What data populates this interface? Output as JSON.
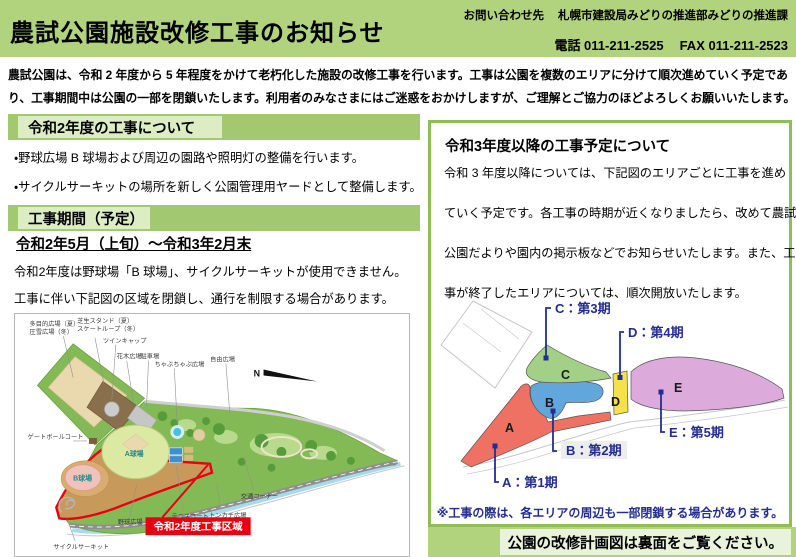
{
  "colors": {
    "banner_green": "#b2d37e",
    "bar_green": "#a2c96f",
    "bar_inner": "#dcecc3",
    "box_border": "#8dbf57",
    "pale_box": "#e9f2da",
    "navy": "#232d91",
    "red": "#e60012",
    "area_a": "#ef7163",
    "area_b": "#61a7dc",
    "area_c": "#a3d086",
    "area_d": "#f6e04b",
    "area_e": "#dcabdc"
  },
  "header": {
    "title": "農試公園施設改修工事のお知らせ",
    "contact_label": "お問い合わせ先",
    "contact_org": "札幌市建設局みどりの推進部みどりの推進課",
    "phone": "電話 011-211-2525",
    "fax": "FAX 011-211-2523"
  },
  "intro_lines": [
    "農試公園は、令和 2 年度から 5 年程度をかけて老朽化した施設の改修工事を行います。工事は公園を複数のエリアに分けて順次進めていく予定であ",
    "り、工事期間中は公園の一部を閉鎖いたします。利用者のみなさまにはご迷惑をおかけしますが、ご理解とご協力のほどよろしくお願いいたします。"
  ],
  "left": {
    "section1_title": "令和2年度の工事について",
    "bullet1": "・野球広場 B 球場および周辺の園路や照明灯の整備を行います。",
    "bullet2": "・サイクルサーキットの場所を新しく公園管理用ヤードとして整備します。",
    "section2_title": "工事期間（予定）",
    "period": "令和2年5月（上旬）～令和3年2月末",
    "line1": "令和2年度は野球場「B 球場」、サイクルサーキットが使用できません。",
    "line2": "工事に伴い下記図の区域を閉鎖し、通行を制限する場合があります。"
  },
  "park_map": {
    "labels": {
      "multipurpose1": "多目的広場（夏）",
      "multipurpose2": "圧雪広場（冬）",
      "lawn1": "芝生スタンド（夏）",
      "lawn2": "スケートループ（冬）",
      "twincap": "ツインキャップ",
      "kaboku": "花木広場",
      "parking": "駐車場",
      "chapu": "ちゃぷちゃぷ広場",
      "jiyu": "自由広場",
      "gateball": "ゲートボールコート",
      "field_a": "A球場",
      "field_b": "B球場",
      "baseball": "野球広場",
      "tennis": "テニスコート",
      "tonkachi": "トンカチ広場",
      "traffic": "交通コーナー",
      "cycle": "サイクルサーキット",
      "compass": "N"
    },
    "zone_label": "令和2年度工事区域"
  },
  "right": {
    "title": "令和3年度以降の工事予定について",
    "body_lines": [
      "令和 3 年度以降については、下記図のエリアごとに工事を進め",
      "ていく予定です。各工事の時期が近くなりましたら、改めて農試",
      "公園だよりや園内の掲示板などでお知らせいたします。また、工",
      "事が終了したエリアについては、順次開放いたします。"
    ],
    "diagram": {
      "areas": [
        {
          "id": "A",
          "label": "A：第1期",
          "color": "#ef7163"
        },
        {
          "id": "B",
          "label": "B：第2期",
          "color": "#61a7dc"
        },
        {
          "id": "C",
          "label": "C：第3期",
          "color": "#a3d086"
        },
        {
          "id": "D",
          "label": "D：第4期",
          "color": "#f6e04b"
        },
        {
          "id": "E",
          "label": "E：第5期",
          "color": "#dcabdc"
        }
      ],
      "note": "※工事の際は、各エリアの周辺も一部閉鎖する場合があります。"
    },
    "footer": "公園の改修計画図は裏面をご覧ください。"
  }
}
